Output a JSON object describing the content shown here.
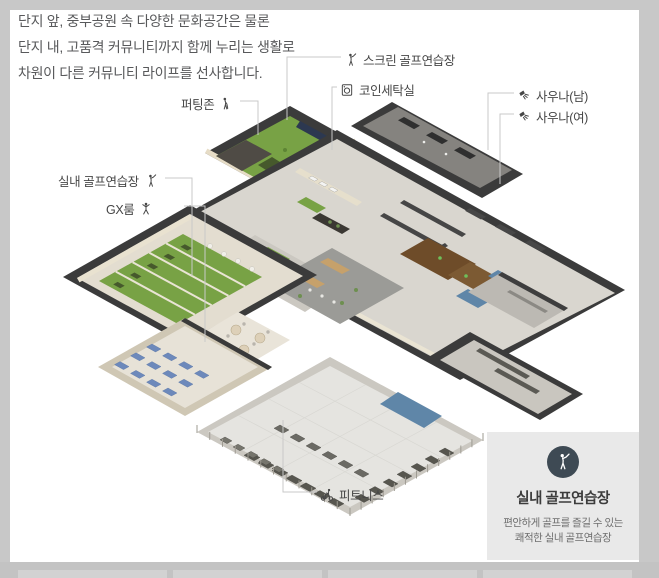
{
  "intro": {
    "lines": [
      "단지 앞, 중부공원 속 다양한 문화공간은 물론",
      "단지 내, 고품격 커뮤니티까지 함께 누리는 생활로",
      "차원이 다른 커뮤니티 라이프를 선사합니다."
    ]
  },
  "labels": {
    "screen_golf": "스크린 골프연습장",
    "coin_laundry": "코인세탁실",
    "putting_zone": "퍼팅존",
    "sauna_men": "사우나(남)",
    "sauna_women": "사우나(여)",
    "indoor_golf": "실내 골프연습장",
    "gx_room": "GX룸",
    "fitness": "피트니스"
  },
  "card": {
    "title": "실내 골프연습장",
    "desc": [
      "편안하게 골프를 즐길 수 있는",
      "쾌적한 실내 골프연습장"
    ]
  },
  "palette": {
    "frame": "#c8c8c8",
    "panel": "#ffffff",
    "intro_text": "#58595b",
    "label_text": "#474747",
    "leader_line": "#c9c9c9",
    "wall_dark": "#3b3b3b",
    "wall_beige": "#e6dfcc",
    "floor_gray": "#d9d6cf",
    "floor_tile": "#e5e4e0",
    "golf_green": "#78a245",
    "tee_green_dark": "#46592c",
    "gx_mat_blue": "#6d89bb",
    "sauna_pool_blue": "#5f86a8",
    "sauna_wood_brown": "#6e4c29",
    "lounge_platform_gray": "#9b9b97",
    "card_bg": "#e9e9e9",
    "card_icon_bg": "#3e4a54",
    "card_title": "#3c3c3c",
    "card_desc": "#6e6e6e",
    "bottom_strip": "#c3c3c3",
    "thumb": "#d2d2d2"
  }
}
